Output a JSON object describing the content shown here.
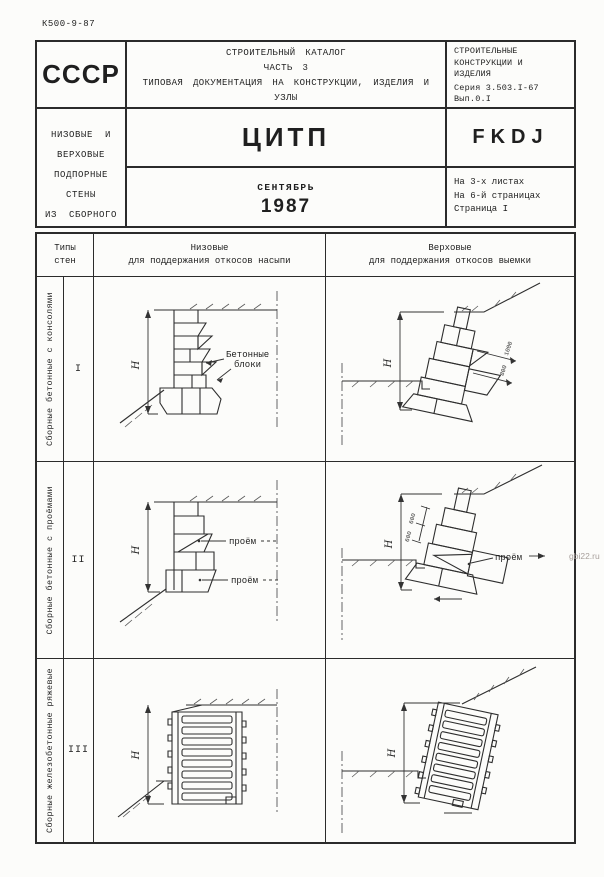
{
  "page": {
    "doc_code": "К500-9-87",
    "watermark": "gbi22.ru"
  },
  "header": {
    "country": "СССР",
    "org": "ЦИТП",
    "month": "СЕНТЯБРЬ",
    "year": "1987",
    "catalog": {
      "line1": "СТРОИТЕЛЬНЫЙ КАТАЛОГ",
      "line2": "ЧАСТЬ 3",
      "line3": "ТИПОВАЯ ДОКУМЕНТАЦИЯ НА КОНСТРУКЦИИ, ИЗДЕЛИЯ И УЗЛЫ",
      "line4": "ЗДАНИЙ И СООРУЖЕНИЙ"
    },
    "subject": {
      "line1": "НИЗОВЫЕ И ВЕРХОВЫЕ ПОДПОРНЫЕ СТЕНЫ",
      "line2": "ИЗ СБОРНОГО И МОНОЛИТНОГО БЕТОНА И ЖЕЛЕЗОБЕТОНА",
      "line3": "НА АВТОМОБИЛЬНЫХ ДОРОГАХ"
    },
    "series": {
      "line1": "СТРОИТЕЛЬНЫЕ",
      "line2": "КОНСТРУКЦИИ И",
      "line3": "ИЗДЕЛИЯ",
      "line4": "Серия 3.503.I-67",
      "line5": "Вып.0.I",
      "line6": "УДК 69.022"
    },
    "code": "FKDJ",
    "sheets": {
      "line1": "На 3-х листах",
      "line2": "На 6-й страницах",
      "line3": "Страница I"
    }
  },
  "table": {
    "types_header": {
      "line1": "Типы",
      "line2": "стен"
    },
    "low_header": {
      "line1": "Низовые",
      "line2": "для поддержания откосов насыпи"
    },
    "high_header": {
      "line1": "Верховые",
      "line2": "для поддержания откосов выемки"
    },
    "rows": [
      {
        "num": "I",
        "label": "Сборные бетонные с консолями"
      },
      {
        "num": "II",
        "label": "Сборные бетонные с проёмами"
      },
      {
        "num": "III",
        "label": "Сборные железобетонные ряжевые"
      }
    ]
  },
  "diagrams": {
    "dim_h": "Н",
    "blocks_label": {
      "line1": "Бетонные",
      "line2": "блоки"
    },
    "opening_label": "проём",
    "dim_1000": "1000",
    "dim_800": "800",
    "dim_600": "600"
  },
  "colors": {
    "ink": "#2b2b2b",
    "paper": "#fcfcfa",
    "watermark_gray": "#a8a09c"
  }
}
